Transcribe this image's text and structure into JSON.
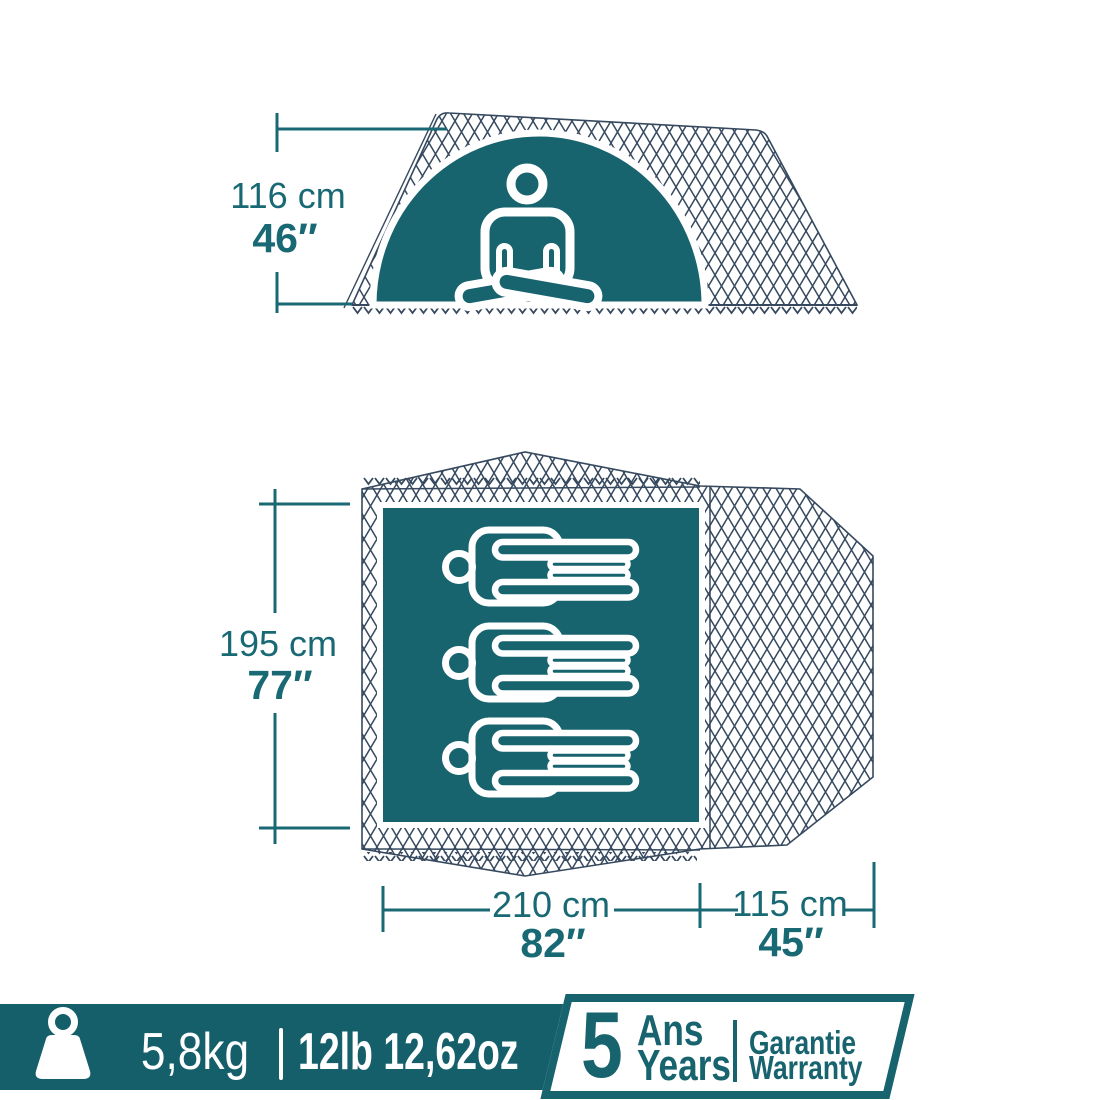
{
  "side_view": {
    "height_cm": "116 cm",
    "height_in": "46″"
  },
  "floor_plan": {
    "capacity_persons": 3,
    "depth_cm": "195 cm",
    "depth_in": "77″",
    "bedroom_width_cm": "210 cm",
    "bedroom_width_in": "82″",
    "porch_width_cm": "115 cm",
    "porch_width_in": "45″"
  },
  "footer": {
    "weight_metric": "5,8kg",
    "separator": "|",
    "weight_imperial": "12lb 12,62oz",
    "warranty": {
      "years_number": "5",
      "years_fr": "Ans",
      "years_en": "Years",
      "label_fr": "Garantie",
      "label_en": "Warranty"
    }
  },
  "colors": {
    "teal": "#17636E",
    "teal_text": "#196974",
    "bar_teal": "#155F6B",
    "mesh_line": "#36495F",
    "white": "#FFFFFF"
  }
}
